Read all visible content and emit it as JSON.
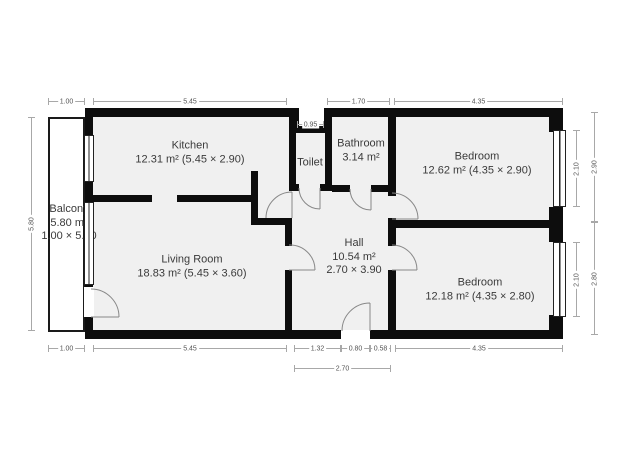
{
  "floorplan": {
    "rooms": {
      "kitchen": {
        "name": "Kitchen",
        "details": "12.31 m² (5.45 × 2.90)"
      },
      "toilet": {
        "name": "Toilet"
      },
      "bathroom": {
        "name": "Bathroom",
        "details": "3.14 m²"
      },
      "bedroom_top": {
        "name": "Bedroom",
        "details": "12.62 m² (4.35 × 2.90)"
      },
      "living_room": {
        "name": "Living Room",
        "details": "18.83 m² (5.45 × 3.60)"
      },
      "hall": {
        "name": "Hall",
        "details": "10.54 m²",
        "dimensions": "2.70 × 3.90"
      },
      "bedroom_bottom": {
        "name": "Bedroom",
        "details": "12.18 m² (4.35 × 2.80)"
      },
      "balcony": {
        "name": "Balcony",
        "details": "5.80 m²",
        "dimensions": "1.00 × 5.80"
      }
    },
    "dims": {
      "top_balcony": "1.00",
      "top_kitchen": "5.45",
      "top_toilet": "0.95",
      "top_bathroom": "1.70",
      "top_bedroom": "4.35",
      "bottom_balcony": "1.00",
      "bottom_living": "5.45",
      "bottom_hall_left": "1.32",
      "bottom_hall_door": "0.80",
      "bottom_hall_right": "0.58",
      "bottom_bedroom": "4.35",
      "bottom_hall_total": "2.70",
      "left_balcony": "5.80",
      "right_window_top": "2.10",
      "right_bedroom_top": "2.90",
      "right_window_bottom": "2.10",
      "right_bedroom_bottom": "2.80"
    },
    "colors": {
      "wall": "#0d0d0d",
      "room_fill": "#f0f0f0",
      "dim_line": "#a8a8a8"
    }
  }
}
